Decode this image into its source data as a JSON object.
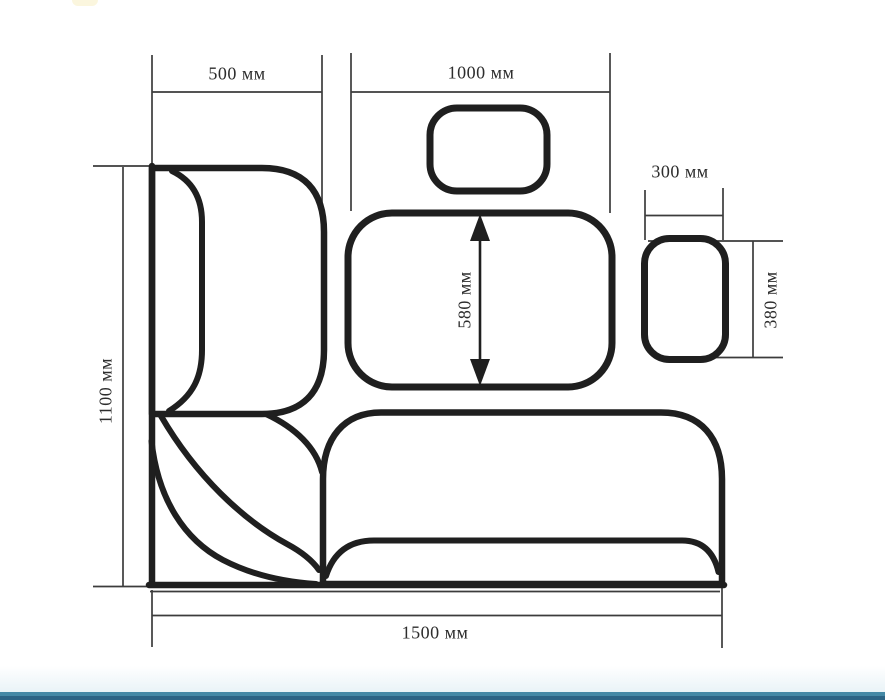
{
  "diagram": {
    "title": "corner-bench-dimension-drawing",
    "unit_suffix": "мм",
    "labels": {
      "width_left": "500 мм",
      "width_main": "1000 мм",
      "width_side_cushion": "300 мм",
      "height_side_cushion": "380 мм",
      "height_backrest_cushion": "580 мм",
      "height_total": "1100 мм",
      "width_total": "1500 мм"
    },
    "values_mm": {
      "width_left": 500,
      "width_main": 1000,
      "width_side_cushion": 300,
      "height_side_cushion": 380,
      "height_backrest_cushion": 580,
      "height_total": 1100,
      "width_total": 1500
    },
    "colors": {
      "outline": "#1f1f1f",
      "dimension": "#3c3c3c",
      "text": "#2d2d2d",
      "footer_teal": "#4489a6",
      "footer_teal_dark": "#2c6485",
      "footer_fade": "#e9f3f7",
      "top_smudge": "#fbf5da"
    }
  }
}
